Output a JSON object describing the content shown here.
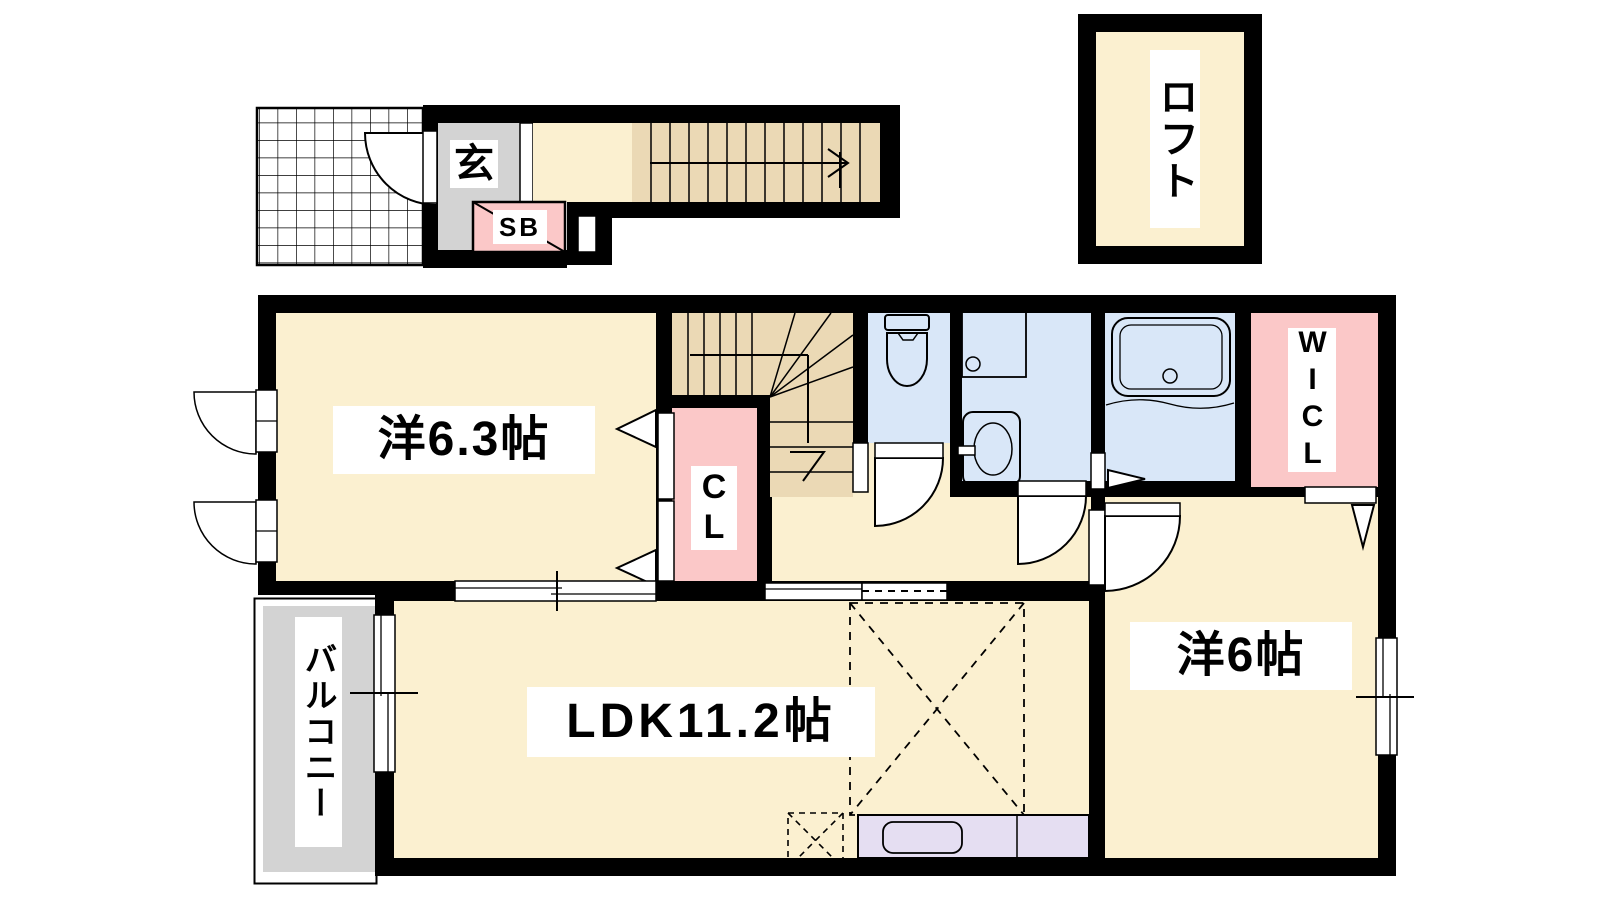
{
  "plan_title": "2F apartment floor plan",
  "rooms": {
    "loft": "ロフト",
    "entrance": "玄",
    "shoe_box": "SB",
    "western_room_1": "洋6.3帖",
    "closet": "CL",
    "walk_in_closet": "WICL",
    "balcony": "バルコニー",
    "ldk": "LDK11.2帖",
    "western_room_2": "洋6帖"
  },
  "colors": {
    "wall": "#000000",
    "room_floor": "#FBF0D0",
    "stairs": "#EBD9B5",
    "closet_pink": "#FBC8C8",
    "sanitary_blue": "#D9E7F8",
    "kitchen_lavender": "#E5DEF2",
    "outdoor_gray": "#D3D3D3",
    "background": "#FFFFFF"
  }
}
